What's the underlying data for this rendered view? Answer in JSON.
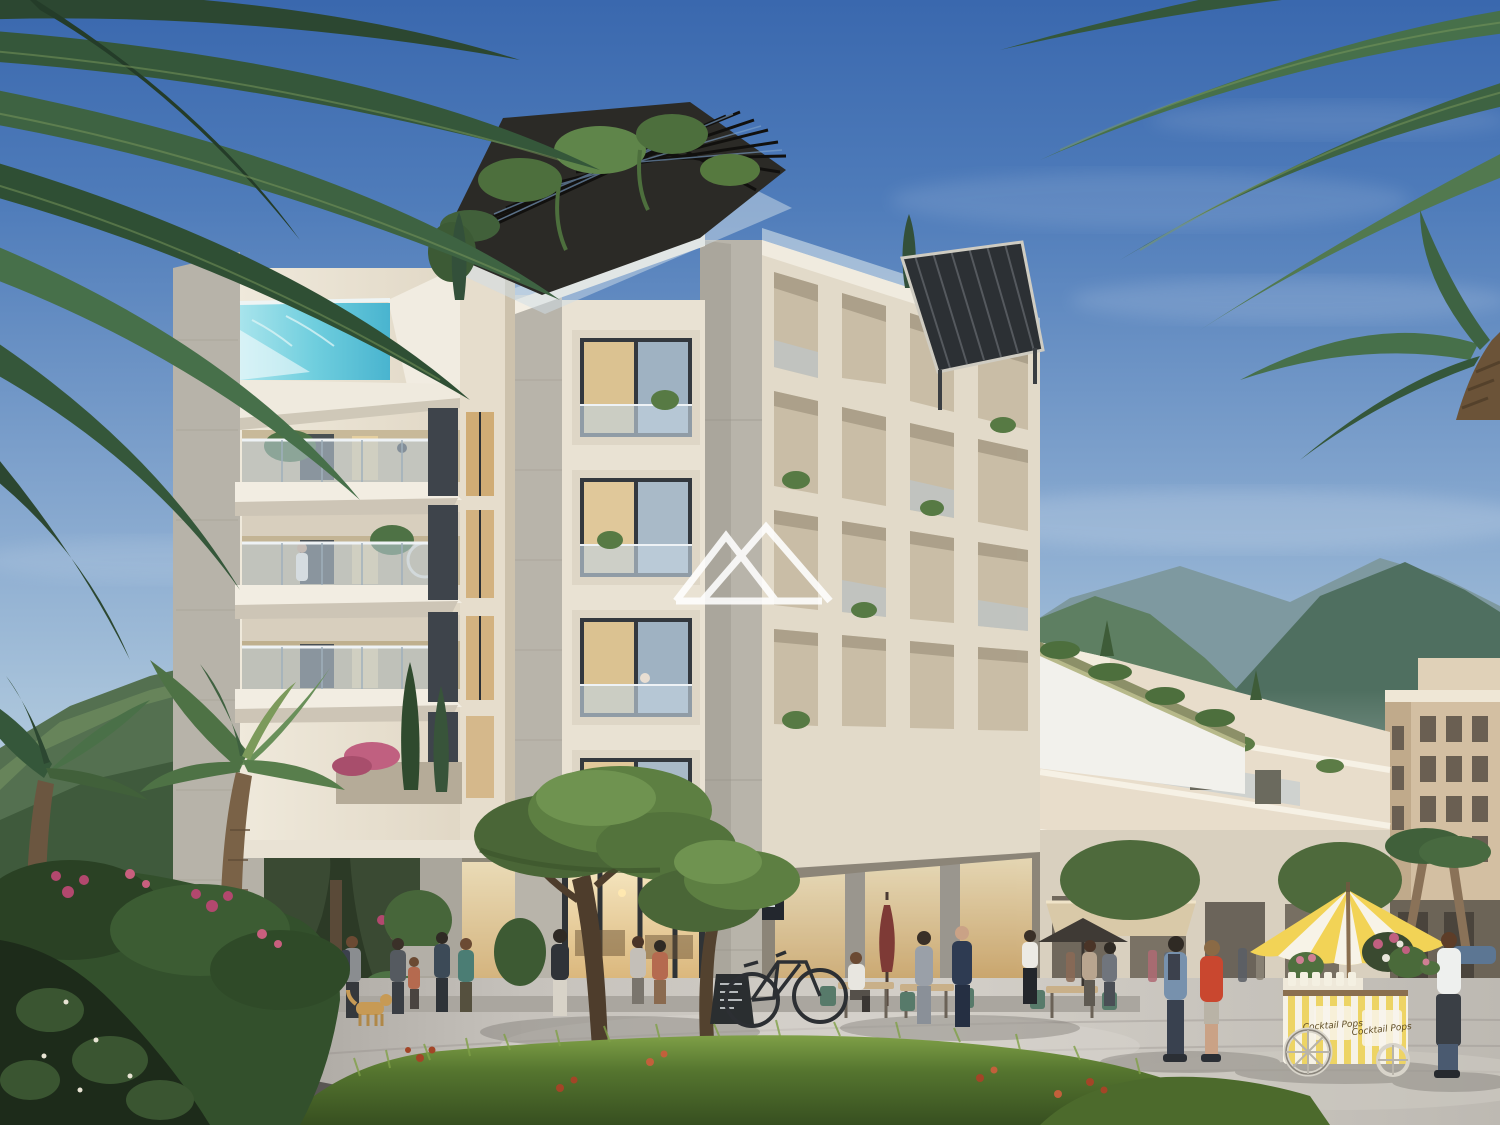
{
  "image_type": "architectural-render",
  "subject": "Modern cream stone apartment complex with rooftop pool and pergola, street cafes, plaza with flower cart, palm trees and green mountains",
  "watermark": {
    "description": "double-mountain-peak outline logo",
    "color": "#ffffff"
  },
  "cart": {
    "script_text": "Cocktail Pops",
    "stripe_colors": [
      "#f2d356",
      "#f7f3e7"
    ],
    "umbrella": "yellow and white striped parasol",
    "items": [
      "flower bouquets",
      "paper cups"
    ]
  },
  "signs": {
    "cafe_blade_sign": "illegible small white text on dark sign",
    "chalkboard": "illegible chalk menu on A-frame board"
  },
  "palette": {
    "sky_top": "#3a68ae",
    "sky_horizon": "#cdd9e4",
    "building_lit": "#ece5d6",
    "building_shaded": "#cfc5b2",
    "stone_pier": "#b5b1a7",
    "pool_water": "#6fcede",
    "pergola_dark": "#26251f",
    "glass_cool": "#b9cbd8",
    "glass_warm": "#e2c48e",
    "mountain_green": "#5e7f62",
    "mountain_haze": "#8aa3a8",
    "plaza": "#c6c2bc",
    "grass": "#55752f",
    "flower_red": "#a34527",
    "umbrella_yellow": "#f2d356",
    "palm_green": "#35573a"
  },
  "scene_inventory": [
    "rooftop pergola with climbing plants",
    "glass infinity pool on tower roof",
    "cantilevered balconies with glass railings",
    "grid facade with square openings",
    "ground floor cafe with warm lit windows",
    "bicycle leaning on concrete pillar",
    "closed maroon patio umbrella",
    "flower cart with striped parasol and vendor",
    "umbrella pine trees and cypresses",
    "palm fronds framing top corners",
    "people strolling on stone plaza",
    "golden dog",
    "green mountains and hazy ridge",
    "terraced white residences stepping downhill",
    "beige hotel building far right"
  ]
}
